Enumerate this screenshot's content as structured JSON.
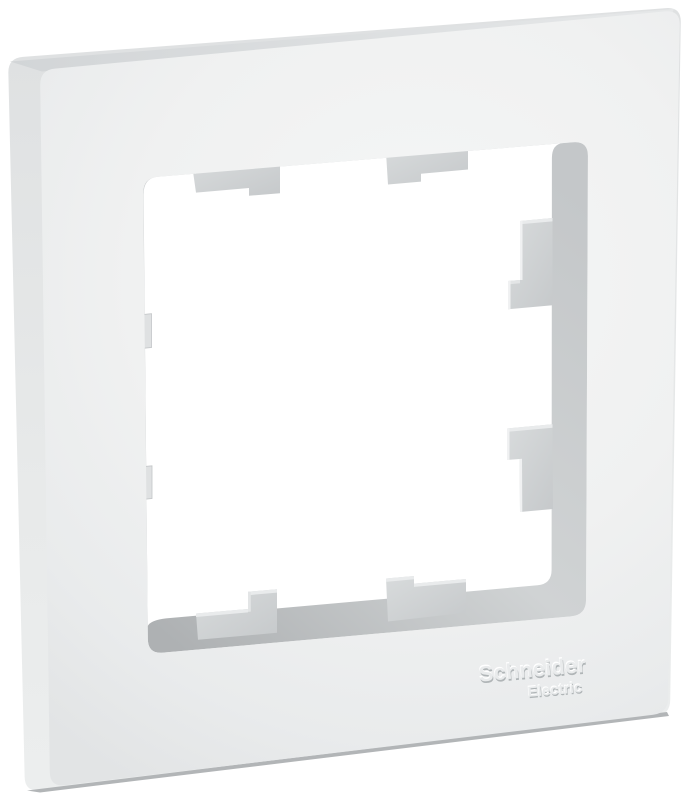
{
  "product": {
    "description": "White single-gang electrical wall plate frame with square opening and mounting tabs",
    "brand_line1": "Schneider",
    "brand_line2": "Electric",
    "colors": {
      "background": "#ffffff",
      "frame_front": "#eef0f0",
      "frame_side_left": "#e7e9ea",
      "frame_side_top": "#d8dadc",
      "frame_side_bottom": "#b2b5b7",
      "inner_wall": "#cbced0",
      "mounting_tab": "#d2d5d7",
      "emboss_highlight": "#ffffff",
      "emboss_shadow": "#aab0b2"
    },
    "parts": {
      "opening": "square central window opening",
      "tabs": [
        "top-left",
        "top-right",
        "right-upper",
        "right-lower",
        "bottom-left",
        "bottom-right",
        "left-upper",
        "left-lower"
      ]
    }
  }
}
